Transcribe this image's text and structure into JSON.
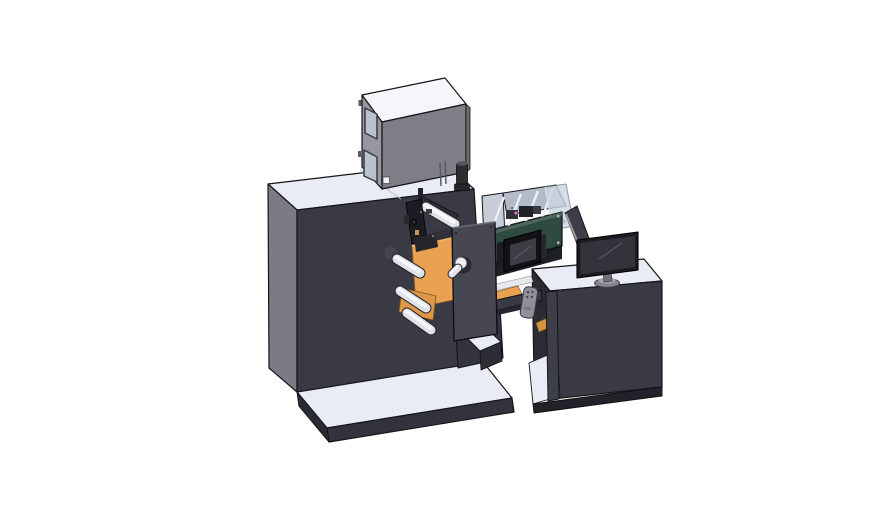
{
  "meta": {
    "title": "3D CAD render of a roll-label printing machine with operator desk",
    "background": "#ffffff"
  },
  "palette": {
    "bg": "#ffffff",
    "edge": "#15151a",
    "top_light": "#eaecf5",
    "dark_front": "#3a3a45",
    "side_gray": "#7b7b86",
    "box_top": "#f5f6f9",
    "box_front": "#7f7e86",
    "box_side": "#98979f",
    "window_glass": "#b9c3cf",
    "orange": "#e8a251",
    "teal_green": "#2f4a41",
    "plate": "#474751",
    "beam": "#3a3a44",
    "pendant": "#8f909a",
    "monitor_screen": "#33333b",
    "screen_dark": "#121216",
    "interior_wall": "#c6ccd8",
    "interior_floor": "#9aa0ac",
    "glass_pane": "#cdd6e4",
    "magenta": "#c561bf",
    "roller_body": "#e0e3ea"
  },
  "components": [
    {
      "id": "main-cabinet",
      "label": "Main machine cabinet"
    },
    {
      "id": "filter-box",
      "label": "Filter box on cabinet top"
    },
    {
      "id": "inspection-box",
      "label": "Open inspection chamber"
    },
    {
      "id": "vision-unit",
      "label": "Control unit with touchscreen"
    },
    {
      "id": "roller-unit",
      "label": "Web roller and print-head unit"
    },
    {
      "id": "bridge",
      "label": "Transfer bridge with control pendant"
    },
    {
      "id": "desk",
      "label": "Operator desk"
    },
    {
      "id": "monitor",
      "label": "Desktop monitor"
    },
    {
      "id": "base-platform",
      "label": "Machine base platform"
    },
    {
      "id": "lower-step",
      "label": "Lower step pedestal"
    }
  ]
}
